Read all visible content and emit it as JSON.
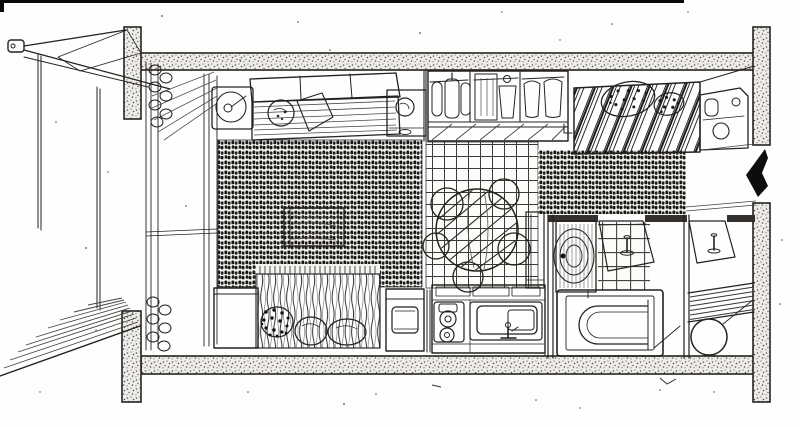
{
  "meta": {
    "title": "Hand-drawn cutaway floor plan sketch of a small studio apartment",
    "medium": "black ink line drawing on white paper",
    "text_content": "none"
  },
  "palette": {
    "paper": "#ffffff",
    "ink": "#24211e",
    "wall_stipple_bg": "#efede9",
    "carpet_dark": "#181715",
    "arrow": "#0d0d0d"
  },
  "elements": {
    "balcony": [
      "railing-post",
      "hand-rails",
      "hatched-canopy",
      "support-posts",
      "glass-door-tracks",
      "curtains",
      "plank-deck"
    ],
    "living_area": [
      "swivel-armchair",
      "sofa",
      "round-cushion",
      "hatched-cushion",
      "side-table-with-bowl",
      "low-wood-table",
      "dark-woven-carpet"
    ],
    "wardrobe": [
      "hanging-clothes",
      "dark-garment",
      "hanger-loop",
      "shirts",
      "under-shelf-braces"
    ],
    "sleeping_area_top": [
      "bed",
      "diagonal-striped-duvet",
      "spotted-pillow-large",
      "spotted-pillow-small",
      "headboard-shelf",
      "dark-floor-mat"
    ],
    "dining_area": [
      "tiled-floor",
      "round-table-with-striped-cloth",
      "stools",
      "tall-cabinet"
    ],
    "kitchen": [
      "waste-unit-with-open-lid",
      "two-burner-stove",
      "sink-basin",
      "faucet",
      "counter-top"
    ],
    "sleeping_area_bottom": [
      "nightstand",
      "striped-fringed-cover",
      "dark-spotted-pillow",
      "white-pillows"
    ],
    "bathroom": [
      "washing-machine",
      "tiled-floor",
      "bathtub",
      "open-door-with-handle"
    ],
    "wc": [
      "louvre-shelf",
      "round-basin",
      "open-door-with-handle"
    ],
    "entrance": [
      "black-arrow-pointing-left",
      "step-lines"
    ],
    "structure": [
      "stippled-top-wall",
      "stippled-bottom-wall",
      "corner-pillars",
      "scan-edge-line"
    ]
  }
}
